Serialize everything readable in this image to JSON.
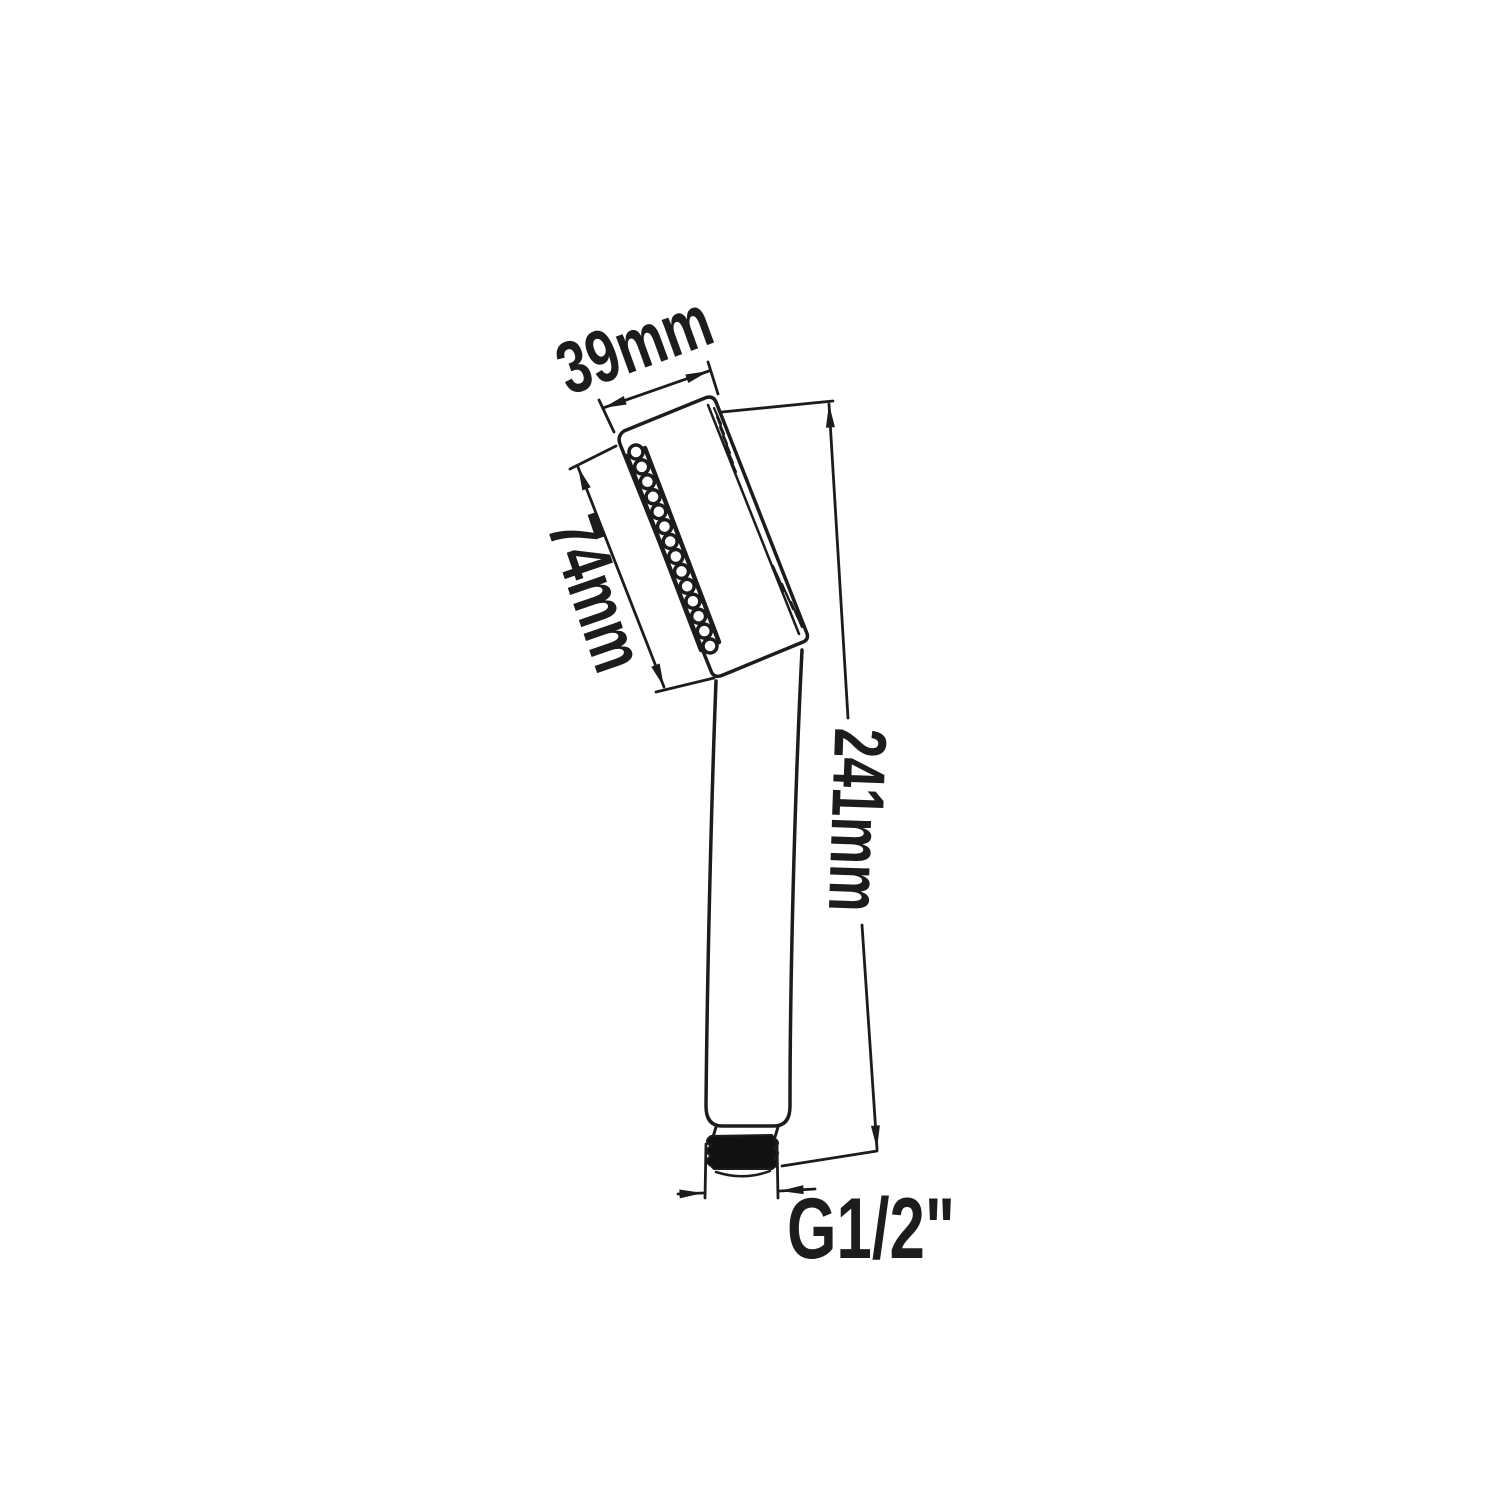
{
  "diagram": {
    "subject": "handheld shower head technical drawing",
    "dimensions": {
      "head_width": "39mm",
      "face_length": "74mm",
      "overall_length": "241mm",
      "thread_size": "G1/2\""
    },
    "colors": {
      "line": "#1c1c1c",
      "thread_fill": "#111111",
      "background": "#ffffff"
    }
  }
}
